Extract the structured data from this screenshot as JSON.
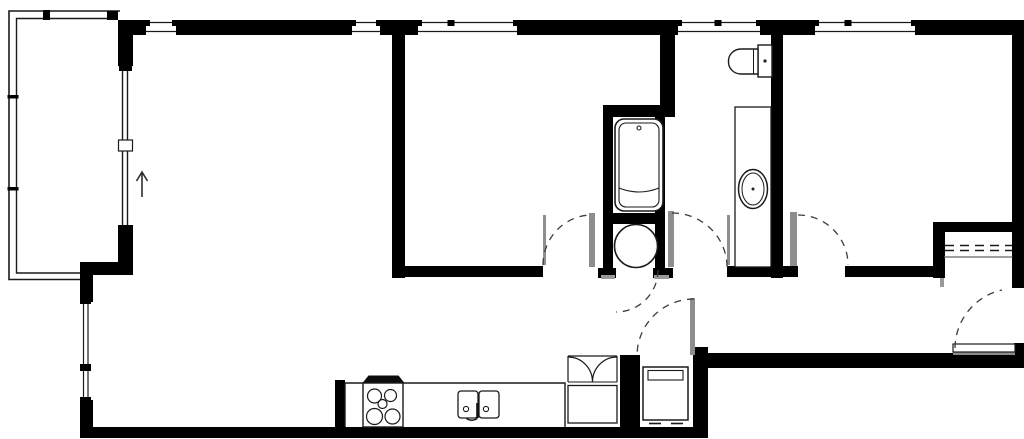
{
  "meta": {
    "canvas": {
      "w": 1024,
      "h": 439
    },
    "colors": {
      "bg": "#ffffff",
      "wall": "#000000",
      "line": "#1a1a1a",
      "leaf": "#8e8e8e",
      "jamb": "#9a9a9a",
      "dash": "#3c3c3c",
      "shelf": "#666666"
    }
  },
  "rooms": [
    {
      "n": "balcony",
      "b": [
        10,
        12,
        108,
        260
      ]
    },
    {
      "n": "living-room",
      "b": [
        95,
        36,
        295,
        390
      ]
    },
    {
      "n": "bedroom-2",
      "b": [
        405,
        36,
        250,
        228
      ]
    },
    {
      "n": "bathroom-tub-room",
      "b": [
        613,
        117,
        42,
        96
      ]
    },
    {
      "n": "water-heater-closet",
      "b": [
        613,
        224,
        42,
        44
      ]
    },
    {
      "n": "wc-bathroom",
      "b": [
        675,
        36,
        96,
        229
      ]
    },
    {
      "n": "bedroom-1",
      "b": [
        785,
        36,
        227,
        229
      ]
    },
    {
      "n": "closet",
      "b": [
        945,
        232,
        67,
        46
      ]
    },
    {
      "n": "hallway",
      "b": [
        405,
        278,
        288,
        74
      ]
    },
    {
      "n": "entry",
      "b": [
        700,
        278,
        312,
        74
      ]
    },
    {
      "n": "kitchen",
      "b": [
        346,
        354,
        219,
        73
      ]
    },
    {
      "n": "laundry-closet",
      "b": [
        641,
        356,
        51,
        71
      ]
    }
  ],
  "walls": [
    [
      118,
      20,
      30,
      15
    ],
    [
      176,
      20,
      176,
      15
    ],
    [
      380,
      20,
      38,
      15
    ],
    [
      517,
      20,
      161,
      15
    ],
    [
      760,
      20,
      55,
      15
    ],
    [
      915,
      20,
      109,
      15
    ],
    [
      1012,
      20,
      12,
      268
    ],
    [
      1014,
      343,
      10,
      11
    ],
    [
      708,
      353,
      316,
      15
    ],
    [
      693,
      347,
      15,
      91
    ],
    [
      80,
      427,
      628,
      11
    ],
    [
      80,
      262,
      13,
      41
    ],
    [
      80,
      400,
      13,
      38
    ],
    [
      80,
      262,
      53,
      13
    ],
    [
      118,
      225,
      15,
      38
    ],
    [
      118,
      20,
      15,
      46
    ],
    [
      392,
      20,
      13,
      258
    ],
    [
      392,
      266,
      151,
      11
    ],
    [
      660,
      20,
      15,
      97
    ],
    [
      603,
      105,
      72,
      12
    ],
    [
      603,
      105,
      10,
      112
    ],
    [
      655,
      115,
      10,
      110
    ],
    [
      603,
      213,
      62,
      11
    ],
    [
      603,
      222,
      10,
      47
    ],
    [
      655,
      222,
      10,
      47
    ],
    [
      598,
      268,
      18,
      10
    ],
    [
      653,
      268,
      20,
      10
    ],
    [
      771,
      20,
      12,
      258
    ],
    [
      727,
      266,
      71,
      11
    ],
    [
      845,
      266,
      95,
      11
    ],
    [
      933,
      222,
      82,
      10
    ],
    [
      933,
      222,
      12,
      56
    ],
    [
      620,
      355,
      20,
      83
    ],
    [
      335,
      380,
      10,
      48
    ]
  ],
  "windows": [
    {
      "n": "window-living-1",
      "x1": 146,
      "x2": 176,
      "tick": 0
    },
    {
      "n": "window-living-2",
      "x1": 352,
      "x2": 380,
      "tick": 0
    },
    {
      "n": "window-bedroom2",
      "x1": 418,
      "x2": 517,
      "tick": 451
    },
    {
      "n": "window-wc",
      "x1": 678,
      "x2": 760,
      "tick": 718
    },
    {
      "n": "window-bedroom1",
      "x1": 815,
      "x2": 915,
      "tick": 848
    }
  ],
  "elements": [
    {
      "t": "p",
      "n": "balcony-outer-rail",
      "d": "M120,11 L9,11 L9,279.5 L80,279.5",
      "s": 1.6
    },
    {
      "t": "p",
      "n": "balcony-inner-rail",
      "d": "M118,18.5 L16.5,18.5 L16.5,273 L80,273",
      "s": 1.4
    },
    {
      "t": "r",
      "n": "balcony-rail-tick",
      "x": 7.5,
      "y": 95,
      "w": 11,
      "h": 3.5,
      "f": "#000000"
    },
    {
      "t": "r",
      "n": "balcony-rail-tick",
      "x": 7.5,
      "y": 187,
      "w": 11,
      "h": 3.5,
      "f": "#000000"
    },
    {
      "t": "r",
      "n": "balcony-rail-tick",
      "x": 43,
      "y": 10,
      "w": 7,
      "h": 10,
      "f": "#000000"
    },
    {
      "t": "r",
      "n": "balcony-rail-bracket",
      "x": 107,
      "y": 11,
      "w": 11,
      "h": 9,
      "f": "#000000"
    },
    {
      "t": "l",
      "n": "sliding-door-glass",
      "x1": 122.5,
      "y1": 65,
      "x2": 122.5,
      "y2": 225,
      "s": 1.4
    },
    {
      "t": "l",
      "n": "sliding-door-glass",
      "x1": 127.5,
      "y1": 65,
      "x2": 127.5,
      "y2": 225,
      "s": 1.4
    },
    {
      "t": "r",
      "n": "sliding-door-cap",
      "x": 119,
      "y": 64,
      "w": 13,
      "h": 7,
      "f": "#000000"
    },
    {
      "t": "r",
      "n": "sliding-door-handle",
      "x": 118.5,
      "y": 140,
      "w": 14,
      "h": 11,
      "f": "#ffffff",
      "s": 1.2
    },
    {
      "t": "r",
      "n": "window-left-glass",
      "x": 80,
      "y": 302,
      "w": 13,
      "h": 98,
      "f": "#ffffff"
    },
    {
      "t": "l",
      "n": "window-left-pane",
      "x1": 83.5,
      "y1": 302,
      "x2": 83.5,
      "y2": 400,
      "s": 1.2
    },
    {
      "t": "l",
      "n": "window-left-pane",
      "x1": 88,
      "y1": 302,
      "x2": 88,
      "y2": 400,
      "s": 1.2
    },
    {
      "t": "r",
      "n": "window-left-cap",
      "x": 80,
      "y": 300,
      "w": 11,
      "h": 4,
      "f": "#000000"
    },
    {
      "t": "r",
      "n": "window-left-cap",
      "x": 80,
      "y": 397,
      "w": 11,
      "h": 4,
      "f": "#000000"
    },
    {
      "t": "r",
      "n": "window-left-tick",
      "x": 80,
      "y": 364,
      "w": 11,
      "h": 7,
      "f": "#000000"
    },
    {
      "t": "p",
      "n": "entrance-arrow",
      "d": "M142,197 L142,173 M136.5,181 L142,172 L147.5,181",
      "s": 1.6,
      "sc": "#2e2e2e"
    },
    {
      "t": "r",
      "n": "bathtub-outer",
      "x": 615,
      "y": 119,
      "w": 48,
      "h": 92,
      "rx": 9,
      "s": 1.6,
      "f": "#ffffff"
    },
    {
      "t": "r",
      "n": "bathtub-inner",
      "x": 619,
      "y": 123,
      "w": 40,
      "h": 84,
      "rx": 7,
      "s": 1.1
    },
    {
      "t": "p",
      "n": "bathtub-front-edge",
      "d": "M619,188 Q639,196 659,188",
      "s": 1.1
    },
    {
      "t": "c",
      "n": "bathtub-drain",
      "cx": 639,
      "cy": 128,
      "r": 2,
      "s": 1.1
    },
    {
      "t": "c",
      "n": "water-heater",
      "cx": 636,
      "cy": 246,
      "r": 21.5,
      "s": 1.6,
      "f": "#ffffff"
    },
    {
      "t": "r",
      "n": "toilet-tank",
      "x": 758,
      "y": 45,
      "w": 14,
      "h": 32,
      "s": 1.4,
      "f": "#ffffff"
    },
    {
      "t": "p",
      "n": "toilet-bowl",
      "d": "M758,49 L741,49 A12.5,12 0 0 0 728.5,61.5 A12.5,12 0 0 0 741,74 L758,74 Z",
      "s": 1.4,
      "f": "#ffffff"
    },
    {
      "t": "l",
      "n": "toilet-seat-line",
      "x1": 753.5,
      "y1": 49.5,
      "x2": 753.5,
      "y2": 73.5,
      "s": 1
    },
    {
      "t": "c",
      "n": "toilet-flush-button",
      "cx": 765,
      "cy": 61,
      "r": 1.6,
      "f": "#222222"
    },
    {
      "t": "r",
      "n": "vanity-counter",
      "x": 735,
      "y": 107,
      "w": 36,
      "h": 160,
      "s": 1.3,
      "f": "#ffffff"
    },
    {
      "t": "e",
      "n": "vanity-sink-outer",
      "cx": 753,
      "cy": 189,
      "rx": 14.5,
      "ry": 19.5,
      "s": 1.5
    },
    {
      "t": "e",
      "n": "vanity-sink-inner",
      "cx": 753,
      "cy": 189,
      "rx": 11,
      "ry": 16,
      "s": 1
    },
    {
      "t": "c",
      "n": "vanity-sink-drain",
      "cx": 753,
      "cy": 189,
      "r": 1.5,
      "f": "#222222"
    },
    {
      "t": "p",
      "n": "kitchen-counter",
      "d": "M345,427 L345,383 L565,383 L565,427",
      "s": 1.4
    },
    {
      "t": "p",
      "n": "range-hood",
      "d": "M362.5,383 L368.5,375.5 L398.5,375.5 L404.5,383 Z",
      "f": "#0c0c0c"
    },
    {
      "t": "r",
      "n": "stove",
      "x": 363,
      "y": 383,
      "w": 40,
      "h": 44,
      "s": 1.4,
      "f": "#ffffff"
    },
    {
      "t": "c",
      "n": "stove-burner",
      "cx": 374.5,
      "cy": 396,
      "r": 7,
      "s": 1.2
    },
    {
      "t": "c",
      "n": "stove-burner",
      "cx": 390.5,
      "cy": 395.5,
      "r": 6,
      "s": 1.2
    },
    {
      "t": "c",
      "n": "stove-burner-center",
      "cx": 382.5,
      "cy": 404,
      "r": 4.5,
      "s": 1.2
    },
    {
      "t": "c",
      "n": "stove-burner",
      "cx": 374.5,
      "cy": 416.5,
      "r": 8,
      "s": 1.2
    },
    {
      "t": "c",
      "n": "stove-burner",
      "cx": 392.5,
      "cy": 416.5,
      "r": 7.5,
      "s": 1.2
    },
    {
      "t": "r",
      "n": "kitchen-sink-basin",
      "x": 458,
      "y": 391,
      "w": 20,
      "h": 27,
      "rx": 3,
      "s": 1.3,
      "f": "#ffffff"
    },
    {
      "t": "r",
      "n": "kitchen-sink-basin",
      "x": 479,
      "y": 391,
      "w": 20,
      "h": 27,
      "rx": 3,
      "s": 1.3,
      "f": "#ffffff"
    },
    {
      "t": "c",
      "n": "kitchen-sink-control",
      "cx": 466,
      "cy": 409,
      "r": 2.6,
      "s": 1.1
    },
    {
      "t": "c",
      "n": "kitchen-sink-control",
      "cx": 486,
      "cy": 409,
      "r": 2.6,
      "s": 1.1
    },
    {
      "t": "l",
      "n": "kitchen-sink-faucet",
      "x1": 477.5,
      "y1": 403,
      "x2": 477.5,
      "y2": 418,
      "s": 2.6,
      "sc": "#111111"
    },
    {
      "t": "p",
      "n": "kitchen-sink-faucet-spout",
      "d": "M477.5,418.5 Q471,422 466.5,418.5",
      "s": 1.4
    },
    {
      "t": "l",
      "n": "pantry-track",
      "x1": 568,
      "y1": 356,
      "x2": 617,
      "y2": 356,
      "s": 1.2
    },
    {
      "t": "l",
      "n": "pantry-side",
      "x1": 568,
      "y1": 356,
      "x2": 568,
      "y2": 382,
      "s": 1.2
    },
    {
      "t": "l",
      "n": "pantry-side",
      "x1": 617,
      "y1": 356,
      "x2": 617,
      "y2": 382,
      "s": 1.2
    },
    {
      "t": "p",
      "n": "bifold-door",
      "d": "M568,357 A24.5,25 0 0 1 592.5,382",
      "s": 1.2
    },
    {
      "t": "p",
      "n": "bifold-door",
      "d": "M617,357 A24.5,25 0 0 0 592.5,382",
      "s": 1.2
    },
    {
      "t": "l",
      "n": "pantry-shelf-edge",
      "x1": 568,
      "y1": 382,
      "x2": 617,
      "y2": 382,
      "s": 1.1
    },
    {
      "t": "r",
      "n": "pantry-cabinet",
      "x": 568,
      "y": 385.5,
      "w": 49,
      "h": 37.5,
      "s": 1.3,
      "f": "#ffffff"
    },
    {
      "t": "r",
      "n": "washing-machine",
      "x": 643,
      "y": 367,
      "w": 45,
      "h": 53,
      "s": 1.5,
      "f": "#ffffff"
    },
    {
      "t": "r",
      "n": "washing-machine-panel",
      "x": 648,
      "y": 370.5,
      "w": 35,
      "h": 9.5,
      "s": 1.1
    },
    {
      "t": "l",
      "n": "washing-machine-foot",
      "x1": 649,
      "y1": 423.5,
      "x2": 661,
      "y2": 423.5,
      "s": 1.6
    },
    {
      "t": "l",
      "n": "washing-machine-foot",
      "x1": 671,
      "y1": 423.5,
      "x2": 683,
      "y2": 423.5,
      "s": 1.6
    },
    {
      "t": "l",
      "n": "closet-rod",
      "x1": 945,
      "y1": 245.5,
      "x2": 1012,
      "y2": 245.5,
      "s": 1.5,
      "da": "9 6"
    },
    {
      "t": "l",
      "n": "closet-rod",
      "x1": 945,
      "y1": 250.5,
      "x2": 1012,
      "y2": 250.5,
      "s": 1.5,
      "da": "9 6"
    },
    {
      "t": "l",
      "n": "closet-shelf",
      "x1": 944,
      "y1": 257,
      "x2": 1012.5,
      "y2": 257,
      "s": 1.3,
      "sc": "#666666"
    },
    {
      "t": "r",
      "n": "door-jamb",
      "x": 543,
      "y": 215,
      "w": 3,
      "h": 50,
      "f": "#8e8e8e"
    },
    {
      "t": "r",
      "n": "door-leaf-bedroom2",
      "x": 589,
      "y": 213,
      "w": 6,
      "h": 54,
      "f": "#8e8e8e"
    },
    {
      "t": "r",
      "n": "door-leaf-wc",
      "x": 668,
      "y": 211,
      "w": 6,
      "h": 56,
      "f": "#8e8e8e"
    },
    {
      "t": "r",
      "n": "door-jamb",
      "x": 727,
      "y": 215,
      "w": 3,
      "h": 50,
      "f": "#8e8e8e"
    },
    {
      "t": "r",
      "n": "door-leaf-bedroom1",
      "x": 790,
      "y": 212,
      "w": 7,
      "h": 54,
      "f": "#8e8e8e"
    },
    {
      "t": "r",
      "n": "door-leaf-laundry",
      "x": 690,
      "y": 298,
      "w": 5,
      "h": 57,
      "f": "#8e8e8e"
    },
    {
      "t": "r",
      "n": "door-jamb",
      "x": 601,
      "y": 275,
      "w": 14,
      "h": 4,
      "f": "#9a9a9a"
    },
    {
      "t": "r",
      "n": "door-jamb",
      "x": 654,
      "y": 275,
      "w": 15,
      "h": 4,
      "f": "#9a9a9a"
    },
    {
      "t": "r",
      "n": "door-jamb",
      "x": 940,
      "y": 278,
      "w": 4,
      "h": 9,
      "f": "#9a9a9a"
    },
    {
      "t": "r",
      "n": "entry-threshold",
      "x": 953,
      "y": 352,
      "w": 62,
      "h": 3,
      "f": "#8e8e8e"
    },
    {
      "t": "r",
      "n": "entry-door-leaf",
      "x": 953,
      "y": 344,
      "w": 62,
      "h": 8,
      "f": "#ffffff",
      "s": 1.2
    },
    {
      "t": "p",
      "n": "door-swing-bedroom2",
      "d": "M543,265 A49,50 0 0 1 592,215",
      "s": 1.3,
      "sc": "#3c3c3c",
      "da": "7 6"
    },
    {
      "t": "p",
      "n": "door-swing-wc",
      "d": "M672,213 A55,54 0 0 1 727,267",
      "s": 1.3,
      "sc": "#3c3c3c",
      "da": "7 6"
    },
    {
      "t": "p",
      "n": "door-swing-bedroom1",
      "d": "M798,215 A50,50 0 0 1 848,265",
      "s": 1.3,
      "sc": "#3c3c3c",
      "da": "7 6"
    },
    {
      "t": "p",
      "n": "door-swing-laundry",
      "d": "M694,299 A57,57 0 0 0 637,356",
      "s": 1.3,
      "sc": "#3c3c3c",
      "da": "7 6"
    },
    {
      "t": "p",
      "n": "door-swing-heater-closet",
      "d": "M658,270 A42,42 0 0 1 616,312",
      "s": 1.3,
      "sc": "#3c3c3c",
      "da": "7 6"
    },
    {
      "t": "p",
      "n": "door-swing-entry",
      "d": "M955,348 A60,60 0 0 1 1002,290",
      "s": 1.3,
      "sc": "#3c3c3c",
      "da": "7 6"
    }
  ]
}
